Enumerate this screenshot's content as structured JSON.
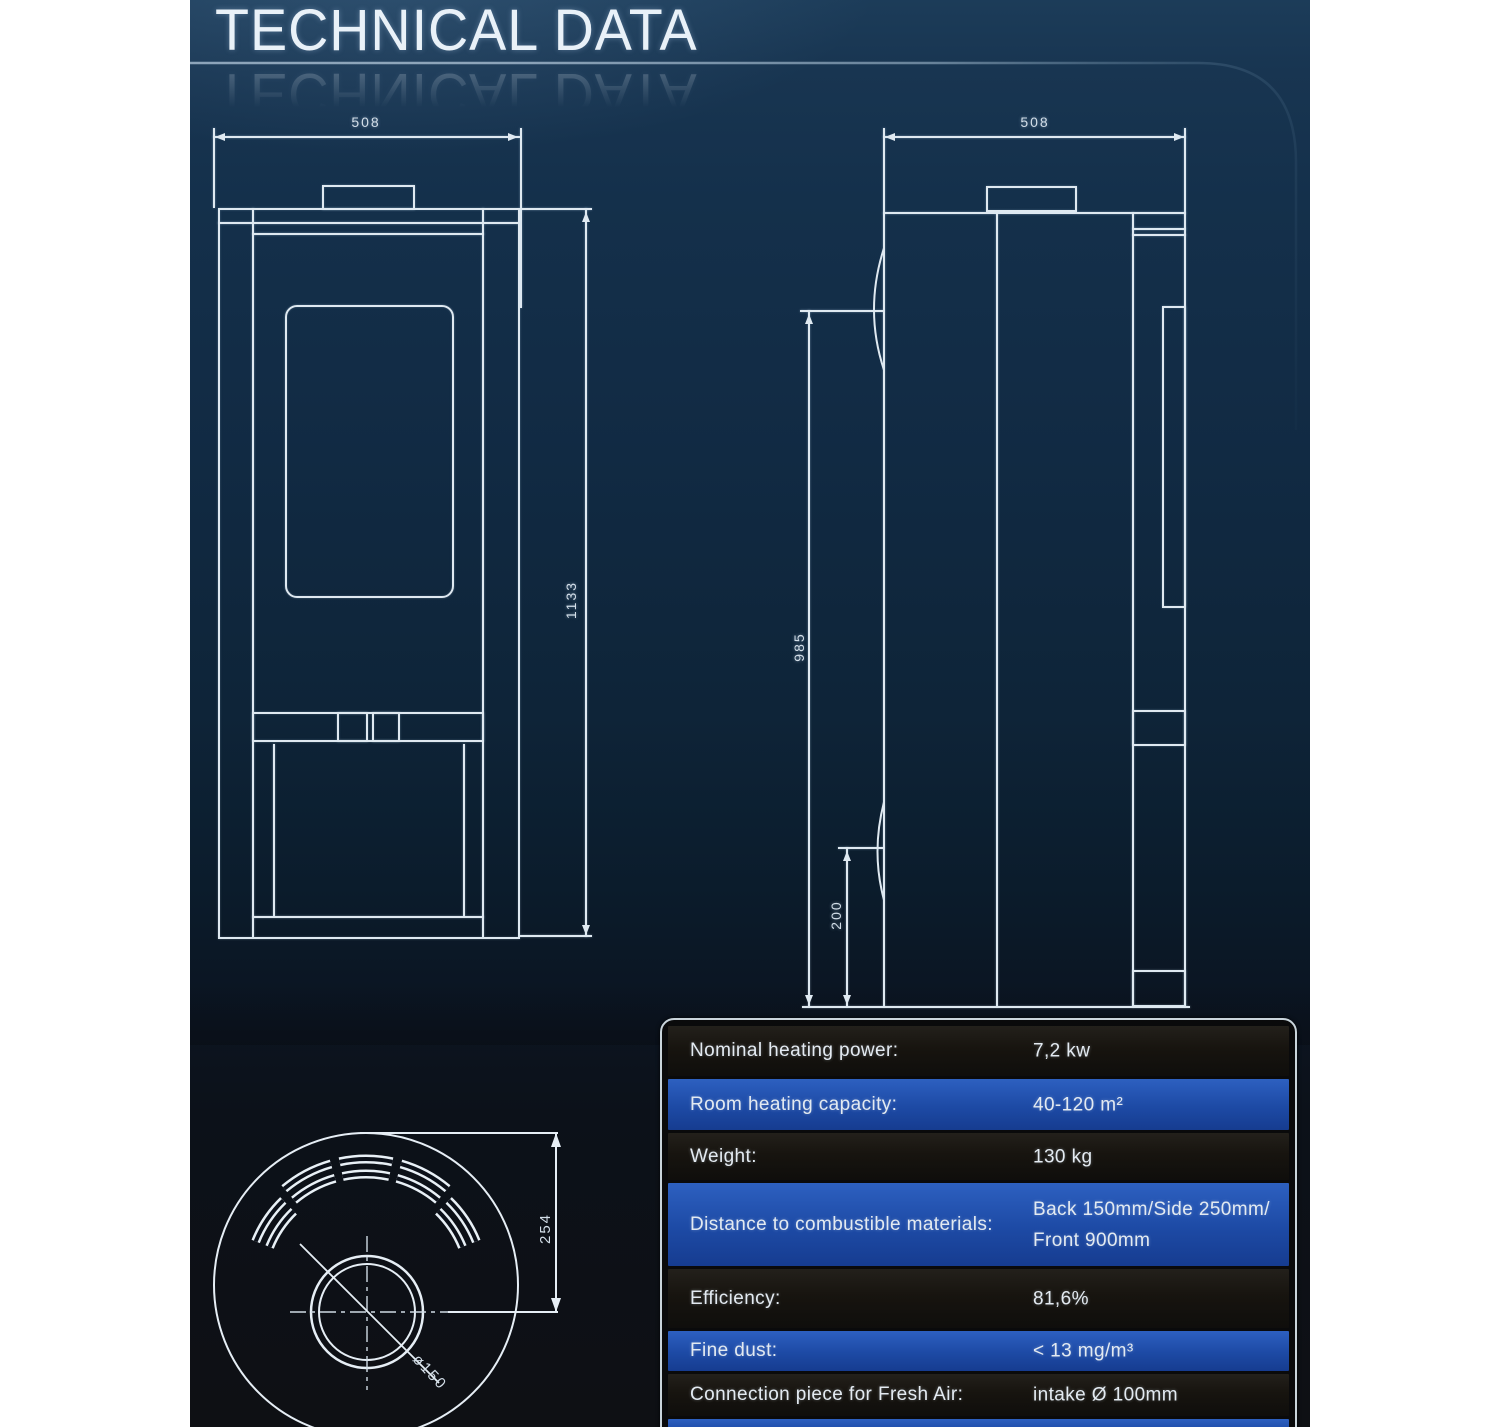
{
  "page": {
    "title": "TECHNICAL DATA"
  },
  "front_view": {
    "width": "508",
    "height": "1133"
  },
  "side_view": {
    "width": "508",
    "height": "985",
    "base_height": "200"
  },
  "top_view": {
    "center_offset": "254",
    "flue_diameter": "ø150"
  },
  "spec_table": {
    "rows": [
      {
        "label": "Nominal heating power:",
        "value": "7,2 kw"
      },
      {
        "label": "Room heating capacity:",
        "value": "40-120 m²"
      },
      {
        "label": "Weight:",
        "value": "130 kg"
      },
      {
        "label": "Distance to combustible materials:",
        "value": "Back 150mm/Side 250mm/",
        "value2": "Front 900mm"
      },
      {
        "label": "Efficiency:",
        "value": "81,6%"
      },
      {
        "label": "Fine dust:",
        "value": "< 13 mg/m³"
      },
      {
        "label": "Connection piece for Fresh Air:",
        "value": "intake Ø 100mm"
      }
    ]
  },
  "colors": {
    "background_navy": "#14304b",
    "line": "#dfe9f1",
    "row_blue": "#1d4aa5",
    "row_dark": "#17140f",
    "table_border": "#c9d4db"
  }
}
